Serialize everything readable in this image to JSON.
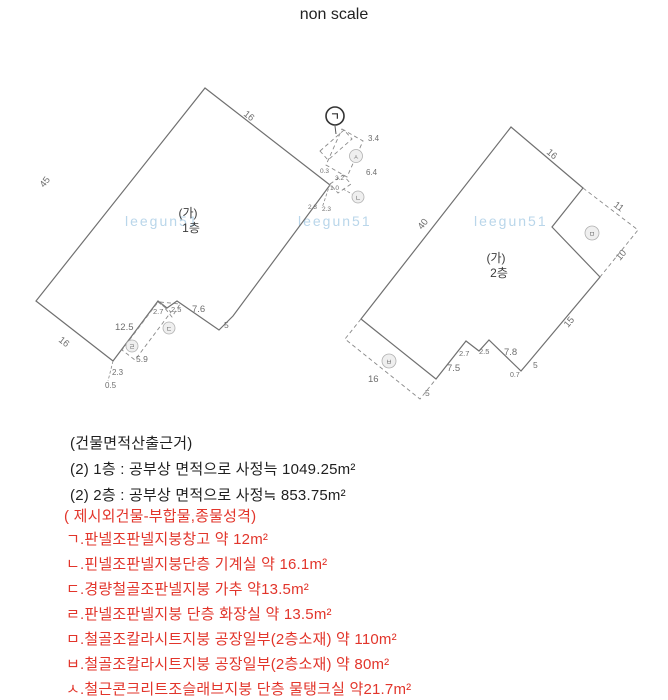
{
  "title": "non scale",
  "watermark": "leegun51",
  "colors": {
    "red_text": "#e2352b",
    "black_text": "#1f1f1f",
    "watermark_blue": "#b9d6ea",
    "line_gray": "#707070",
    "dim_gray": "#6e6e6e"
  },
  "left_building": {
    "unit_label": "(가)",
    "floor_label": "1층",
    "dims": {
      "top": "16",
      "left": "45",
      "bottom_left": "16",
      "bottom": "12.5",
      "notch_a": "2.7",
      "notch_b": "2.5",
      "notch_c": "7.6",
      "corner": "5",
      "spur_a": "2.3",
      "spur_b": "0.5",
      "toilet_len": "5.9",
      "tank_w": "3.4",
      "tank_l": "6.4",
      "mech_a": "0.3",
      "mech_b": "3.2",
      "mech_c": "1.0",
      "mech_d": "2.3",
      "mech_e": "2.3"
    },
    "markers": {
      "storage": "ㄱ",
      "tank": "ㅅ",
      "mech": "ㄴ",
      "canopy": "ㄷ",
      "toilet": "ㄹ"
    }
  },
  "right_building": {
    "unit_label": "(가)",
    "floor_label": "2층",
    "dims": {
      "top": "16",
      "left": "40",
      "dash_a": "11",
      "dash_b": "10",
      "right": "15",
      "bottom": "7.5",
      "notch_a": "2.7",
      "notch_b": "2.5",
      "notch_c": "7.8",
      "corner_a": "0.7",
      "corner_b": "5",
      "annex_l": "16",
      "annex_w": "5"
    },
    "markers": {
      "factory_upper": "ㅁ",
      "factory_lower": "ㅂ"
    }
  },
  "notes": {
    "header": "(건물면적산출근거)",
    "floor1": "(2) 1층 : 공부상 면적으로 사정늑 1049.25m²",
    "floor2": "(2) 2층 : 공부상 면적으로 사정≒ 853.75m²",
    "red_header": "( 제시외건물-부합물,종물성격)",
    "items": [
      "ㄱ.판넬조판넬지붕창고  약 12m²",
      "ㄴ.핀넬조판넬지붕단층 기계실 약 16.1m²",
      "ㄷ.경량철골조판넬지붕  가추 약13.5m²",
      "ㄹ.판넬조판넬지붕 단층 화장실 약 13.5m²",
      "ㅁ.철골조칼라시트지붕 공장일부(2층소재)  약 110m²",
      "ㅂ.철골조칼라시트지붕 공장일부(2층소재)  약 80m²",
      "ㅅ.철근콘크리트조슬래브지붕 단층 물탱크실 약21.7m²"
    ]
  }
}
